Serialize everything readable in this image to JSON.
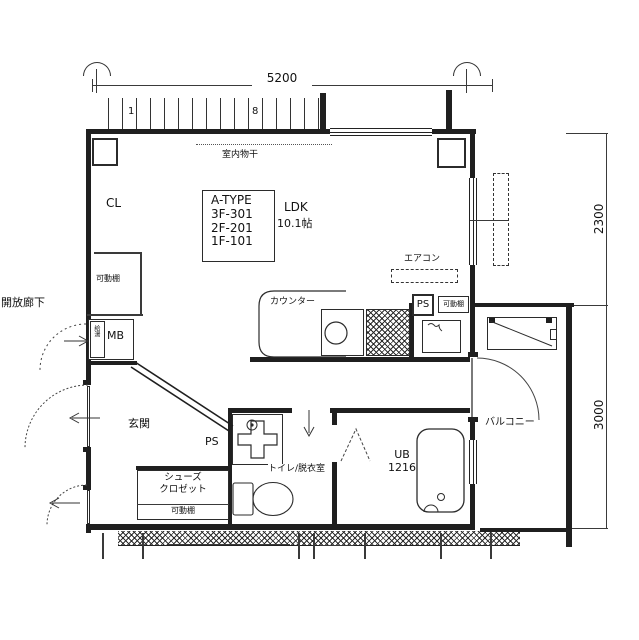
{
  "dimensions": {
    "top_width": "5200",
    "right_upper_height": "2300",
    "right_lower_height": "3000"
  },
  "grid_numbers": {
    "left": "1",
    "right": "8"
  },
  "unit_info": {
    "type": "A-TYPE",
    "room_3f": "3F-301",
    "room_2f": "2F-201",
    "room_1f": "1F-101"
  },
  "rooms": {
    "ldk_name": "LDK",
    "ldk_size": "10.1帖",
    "closet": "CL",
    "entrance": "玄関",
    "toilet_dressing": "トイレ/脱衣室",
    "unit_bath_name": "UB",
    "unit_bath_size": "1216",
    "balcony": "バルコニー",
    "open_corridor": "開放廊下",
    "shoe_closet_line1": "シューズ",
    "shoe_closet_line2": "クロゼット"
  },
  "labels": {
    "indoor_drying": "室内物干",
    "air_conditioner": "エアコン",
    "kitchen_counter": "カウンター",
    "pipe_space_kitchen": "PS",
    "pipe_space_entrance": "PS",
    "meter_box": "MB",
    "water_heater": "給湯",
    "movable_shelf_closet": "可動棚",
    "movable_shelf_kitchen": "可動棚",
    "movable_shelf_shoe": "可動棚"
  }
}
